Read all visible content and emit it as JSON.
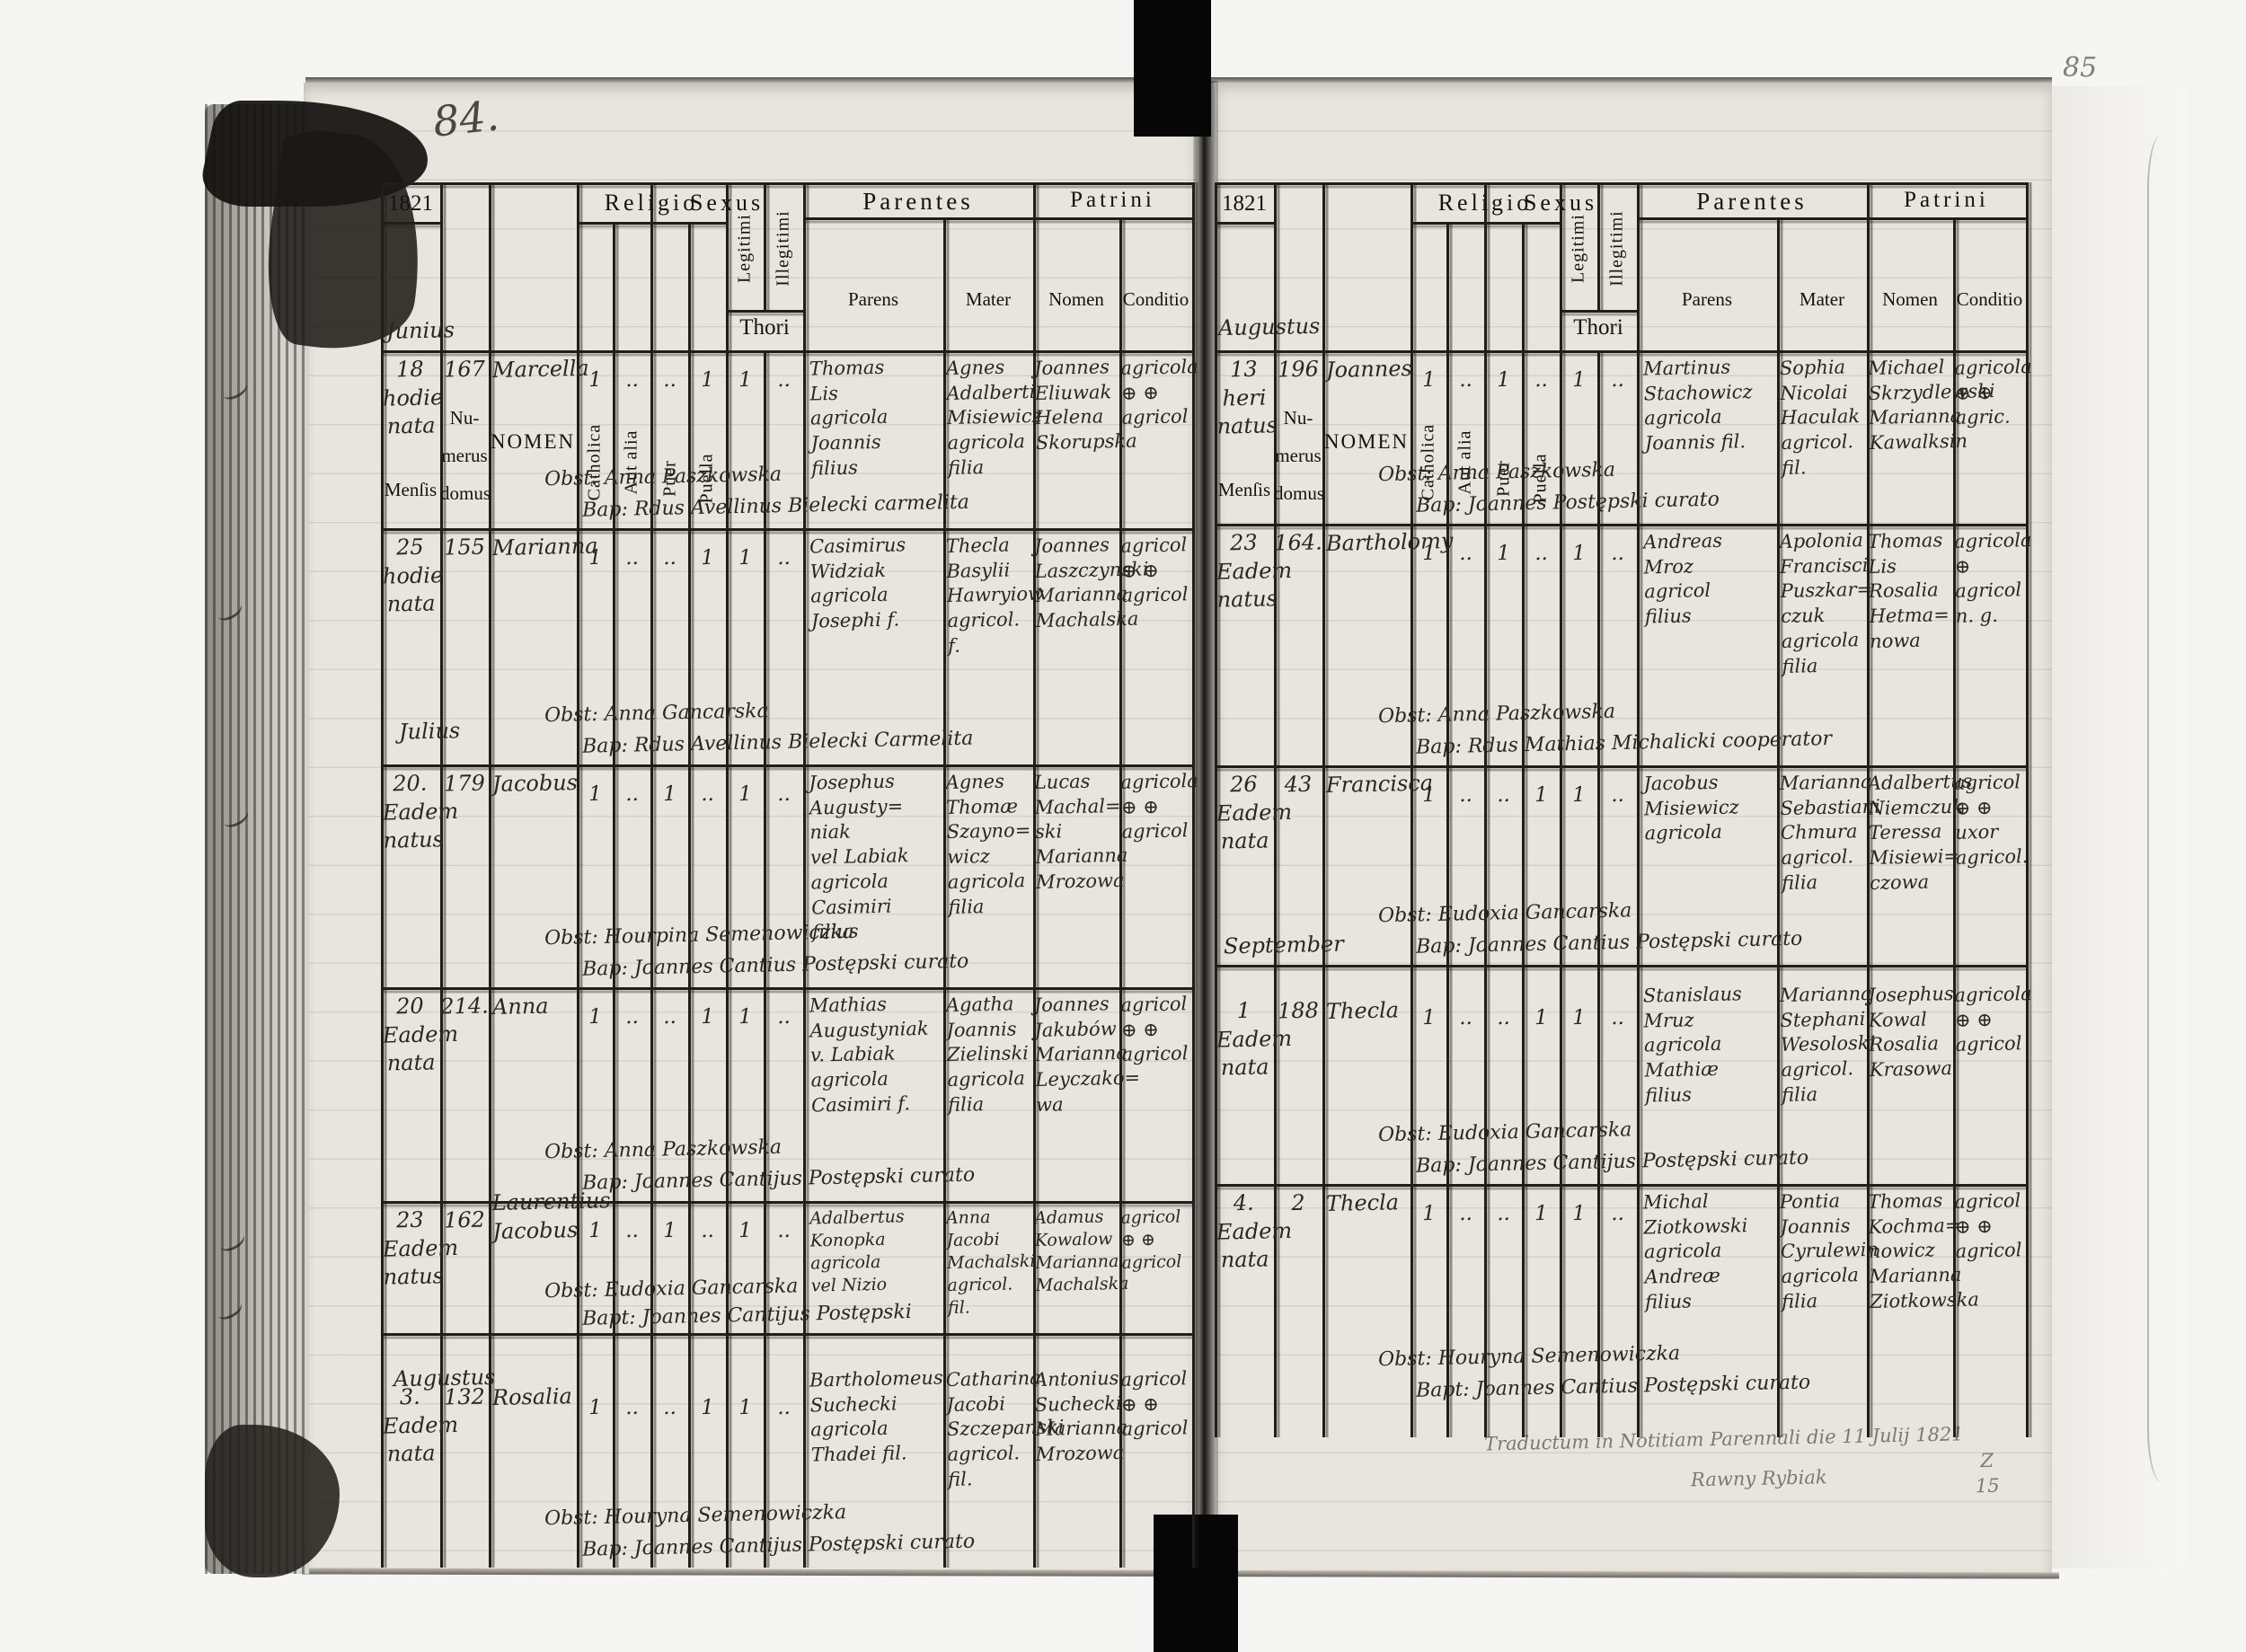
{
  "page_numbers": {
    "left": "84.",
    "right": "85"
  },
  "header": {
    "year": "1821",
    "mensis": "Menſis",
    "numerus_l1": "Nu-",
    "numerus_l2": "merus",
    "numerus_l3": "domus",
    "nomen": "NOMEN",
    "religio": "Religio",
    "catholica": "Catholica",
    "aut_alia": "Aut alia",
    "sexus": "Sexus",
    "puer": "Puer",
    "puella": "Puella",
    "legitimi": "Legitimi",
    "illegitimi": "Illegitimi",
    "thori": "Thori",
    "parentes": "Parentes",
    "parens": "Parens",
    "mater": "Mater",
    "patrini": "Patrini",
    "patrini_nomen": "Nomen",
    "conditio": "Conditio"
  },
  "left_page": {
    "month_annotation": "Junius",
    "julius_marker": "Julius",
    "augustus_marker": "Augustus",
    "entries": [
      {
        "date": "18\nhodie\nnata",
        "house": "167",
        "name": "Marcella",
        "catholica": "1",
        "aut_alia": "..",
        "puer": "..",
        "puella": "1",
        "legitimi": "1",
        "illegitimi": "..",
        "parens": "Thomas\nLis\nagricola\nJoannis\nfilius",
        "mater": "Agnes\nAdalberti\nMisiewicz\nagricola\nfilia",
        "patrini": "Joannes\nEliuwak\nHelena\nSkorupska",
        "conditio": "agricola\n⊕  ⊕\nagricol",
        "obst": "Obst: Anna Paszkowska",
        "bap": "Bap: Rdus Avellinus Bielecki carmelita"
      },
      {
        "date": "25\nhodie\nnata",
        "house": "155",
        "name": "Marianna",
        "catholica": "1",
        "aut_alia": "..",
        "puer": "..",
        "puella": "1",
        "legitimi": "1",
        "illegitimi": "..",
        "parens": "Casimirus\nWidziak\nagricola\nJosephi f.",
        "mater": "Thecla\nBasylii\nHawryiow\nagricol. f.",
        "patrini": "Joannes\nLaszczynski\nMarianna\nMachalska",
        "conditio": "agricol\n⊕  ⊕\nagricol",
        "obst": "Obst: Anna Gancarska",
        "bap": "Bap: Rdus Avellinus Bielecki Carmelita"
      },
      {
        "date": "20.\nEadem\nnatus",
        "house": "179",
        "name": "Jacobus",
        "catholica": "1",
        "aut_alia": "..",
        "puer": "1",
        "puella": "..",
        "legitimi": "1",
        "illegitimi": "..",
        "parens": "Josephus\nAugusty=\nniak\nvel Labiak\nagricola\nCasimiri\nfilius",
        "mater": "Agnes\nThomæ\nSzayno=\nwicz\nagricola\nfilia",
        "patrini": "Lucas\nMachal=\nski\nMarianna\nMrozowa",
        "conditio": "agricola\n⊕  ⊕\nagricol",
        "obst": "Obst: Hourpina Semenowiczka",
        "bap": "Bap: Joannes Cantius Postępski curato"
      },
      {
        "date": "20\nEadem\nnata",
        "house": "214.",
        "name": "Anna",
        "catholica": "1",
        "aut_alia": "..",
        "puer": "..",
        "puella": "1",
        "legitimi": "1",
        "illegitimi": "..",
        "parens": "Mathias\nAugustyniak\nv. Labiak\nagricola\nCasimiri f.",
        "mater": "Agatha\nJoannis\nZielinski\nagricola\nfilia",
        "patrini": "Joannes\nJakubów\nMarianna\nLeyczako=\nwa",
        "conditio": "agricol\n⊕  ⊕\nagricol",
        "obst": "Obst: Anna Paszkowska",
        "bap": "Bap: Joannes Cantijus Postępski curato"
      },
      {
        "date": "23\nEadem\nnatus",
        "house": "162",
        "name": "Laurentius\nJacobus",
        "catholica": "1",
        "aut_alia": "..",
        "puer": "1",
        "puella": "..",
        "legitimi": "1",
        "illegitimi": "..",
        "parens": "Adalbertus\nKonopka\nagricola\nvel Nizio",
        "mater": "Anna\nJacobi\nMachalski\nagricol. fil.",
        "patrini": "Adamus\nKowalow\nMarianna\nMachalska",
        "conditio": "agricol\n⊕  ⊕\nagricol",
        "obst": "Obst: Eudoxia Gancarska",
        "bap": "Bapt: Joannes Cantijus Postępski"
      },
      {
        "date": "3.\nEadem\nnata",
        "house": "132",
        "name": "Rosalia",
        "catholica": "1",
        "aut_alia": "..",
        "puer": "..",
        "puella": "1",
        "legitimi": "1",
        "illegitimi": "..",
        "parens": "Bartholomeus\nSuchecki\nagricola\nThadei fil.",
        "mater": "Catharina\nJacobi\nSzczepanski\nagricol. fil.",
        "patrini": "Antonius\nSuchecki\nMarianna\nMrozowa",
        "conditio": "agricol\n⊕  ⊕\nagricol",
        "obst": "Obst: Houryna Semenowiczka",
        "bap": "Bap: Joannes Cantijus Postępski curato"
      }
    ]
  },
  "right_page": {
    "month_annotation": "Augustus",
    "september_marker": "September",
    "footer_note_line1": "Traductum in Notitiam Parennali die 11 Julij 1821",
    "footer_note_line2": "Rawny Rybiak",
    "corner_mark": "Z\n15",
    "entries": [
      {
        "date": "13\nheri\nnatus",
        "house": "196",
        "name": "Joannes",
        "catholica": "1",
        "aut_alia": "..",
        "puer": "1",
        "puella": "..",
        "legitimi": "1",
        "illegitimi": "..",
        "parens": "Martinus\nStachowicz\nagricola\nJoannis fil.",
        "mater": "Sophia\nNicolai\nHaculak\nagricol. fil.",
        "patrini": "Michael\nSkrzydlewski\nMarianna\nKawalksin",
        "conditio": "agricola\n⊕  ⊕\nagric.",
        "obst": "Obst: Anna Paszkowska",
        "bap": "Bap: Joannes Postępski curato"
      },
      {
        "date": "23\nEadem\nnatus",
        "house": "164.",
        "name": "Bartholomy",
        "catholica": "1",
        "aut_alia": "..",
        "puer": "1",
        "puella": "..",
        "legitimi": "1",
        "illegitimi": "..",
        "parens": "Andreas\nMroz\nagricol\nfilius",
        "mater": "Apolonia\nFrancisci\nPuszkar=\nczuk\nagricola\nfilia",
        "patrini": "Thomas\nLis\nRosalia\nHetma=\nnowa",
        "conditio": "agricola\n⊕\nagricol\nn. g.",
        "obst": "Obst: Anna Paszkowska",
        "bap": "Bap: Rdus Mathias Michalicki cooperator"
      },
      {
        "date": "26\nEadem\nnata",
        "house": "43",
        "name": "Francisca",
        "catholica": "1",
        "aut_alia": "..",
        "puer": "..",
        "puella": "1",
        "legitimi": "1",
        "illegitimi": "..",
        "parens": "Jacobus\nMisiewicz\nagricola",
        "mater": "Marianna\nSebastiani\nChmura\nagricol.\nfilia",
        "patrini": "Adalbertus\nNiemczuk\nTeressa\nMisiewi=\nczowa",
        "conditio": "agricol\n⊕  ⊕\nuxor\nagricol.",
        "obst": "Obst: Eudoxia Gancarska",
        "bap": "Bap: Joannes Cantius Postępski curato"
      },
      {
        "date": "1\nEadem\nnata",
        "house": "188",
        "name": "Thecla",
        "catholica": "1",
        "aut_alia": "..",
        "puer": "..",
        "puella": "1",
        "legitimi": "1",
        "illegitimi": "..",
        "parens": "Stanislaus\nMruz\nagricola\nMathiæ\nfilius",
        "mater": "Marianna\nStephani\nWesoloski\nagricol.\nfilia",
        "patrini": "Josephus\nKowal\nRosalia\nKrasowa",
        "conditio": "agricola\n⊕  ⊕\nagricol",
        "obst": "Obst: Eudoxia Gancarska",
        "bap": "Bap: Joannes Cantijus Postępski curato"
      },
      {
        "date": "4.\nEadem\nnata",
        "house": "2",
        "name": "Thecla",
        "catholica": "1",
        "aut_alia": "..",
        "puer": "..",
        "puella": "1",
        "legitimi": "1",
        "illegitimi": "..",
        "parens": "Michal\nZiotkowski\nagricola\nAndreæ\nfilius",
        "mater": "Pontia\nJoannis\nCyrulewin\nagricola\nfilia",
        "patrini": "Thomas\nKochma=\nnowicz\nMarianna\nZiotkowska",
        "conditio": "agricol\n⊕  ⊕\nagricol",
        "obst": "Obst: Houryna Semenowiczka",
        "bap": "Bapt: Joannes Cantius Postępski curato"
      }
    ]
  }
}
